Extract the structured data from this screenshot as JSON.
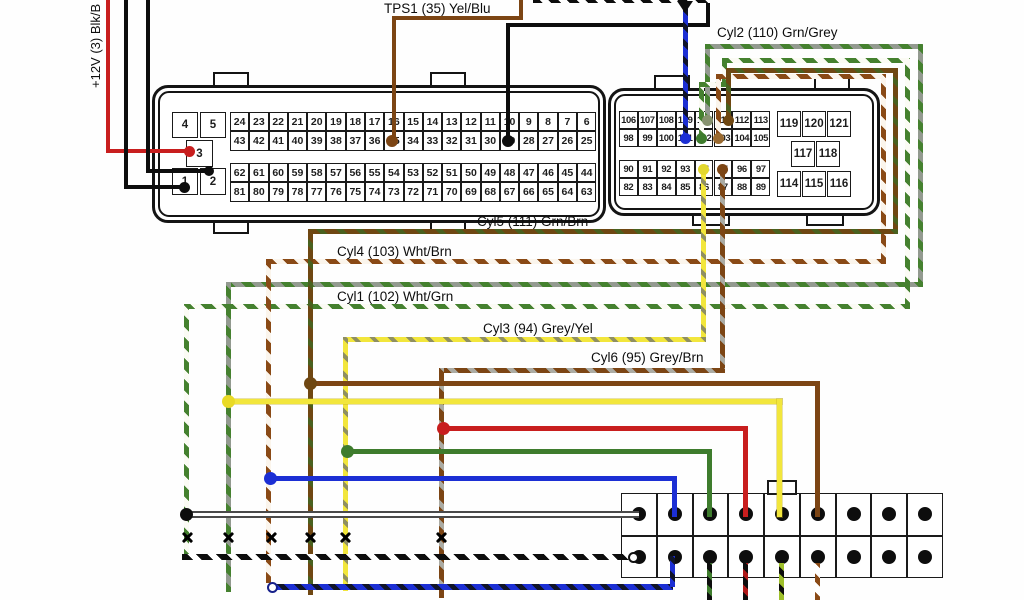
{
  "diagram": {
    "supply_label": "+12V (3) Blk/B",
    "wire_labels": {
      "tps1": "TPS1 (35) Yel/Blu",
      "cyl2": "Cyl2 (110) Grn/Grey",
      "cyl5": "Cyl5 (111) Grn/Brn",
      "cyl4": "Cyl4 (103) Wht/Brn",
      "cyl1": "Cyl1 (102) Wht/Grn",
      "cyl3": "Cyl3 (94) Grey/Yel",
      "cyl6": "Cyl6 (95) Grey/Brn"
    },
    "connector_a": {
      "aux_pins": [
        "4",
        "5",
        "3",
        "1",
        "2"
      ],
      "grid_rows": [
        [
          "24",
          "23",
          "22",
          "21",
          "20",
          "19",
          "18",
          "17",
          "16",
          "15",
          "14",
          "13",
          "12",
          "11",
          "10",
          "9",
          "8",
          "7",
          "6"
        ],
        [
          "43",
          "42",
          "41",
          "40",
          "39",
          "38",
          "37",
          "36",
          "35",
          "34",
          "33",
          "32",
          "31",
          "30",
          "29",
          "28",
          "27",
          "26",
          "25"
        ],
        [
          "62",
          "61",
          "60",
          "59",
          "58",
          "57",
          "56",
          "55",
          "54",
          "53",
          "52",
          "51",
          "50",
          "49",
          "48",
          "47",
          "46",
          "45",
          "44"
        ],
        [
          "81",
          "80",
          "79",
          "78",
          "77",
          "76",
          "75",
          "74",
          "73",
          "72",
          "71",
          "70",
          "69",
          "68",
          "67",
          "66",
          "65",
          "64",
          "63"
        ]
      ]
    },
    "connector_b": {
      "left_rows": [
        [
          "106",
          "107",
          "108",
          "109",
          "110",
          "111",
          "112",
          "113"
        ],
        [
          "98",
          "99",
          "100",
          "101",
          "102",
          "103",
          "104",
          "105"
        ],
        [
          "90",
          "91",
          "92",
          "93",
          "94",
          "95",
          "96",
          "97"
        ],
        [
          "82",
          "83",
          "84",
          "85",
          "86",
          "87",
          "88",
          "89"
        ]
      ],
      "right_groups": [
        [
          "119",
          "120",
          "121"
        ],
        [
          "117",
          "118"
        ],
        [
          "114",
          "115",
          "116"
        ]
      ]
    },
    "bottom_connector": {
      "columns": 9,
      "rows": 2
    },
    "colors": {
      "red": "#c81e1e",
      "black": "#0d0d0d",
      "brown": "#7c4514",
      "dark_brown": "#6f4712",
      "yellow": "#f2e63c",
      "green": "#3e7c2d",
      "blue": "#1c2fd4",
      "grey": "#8f968c",
      "grey_green_dot": "#87926f",
      "navy": "#16208a"
    }
  }
}
